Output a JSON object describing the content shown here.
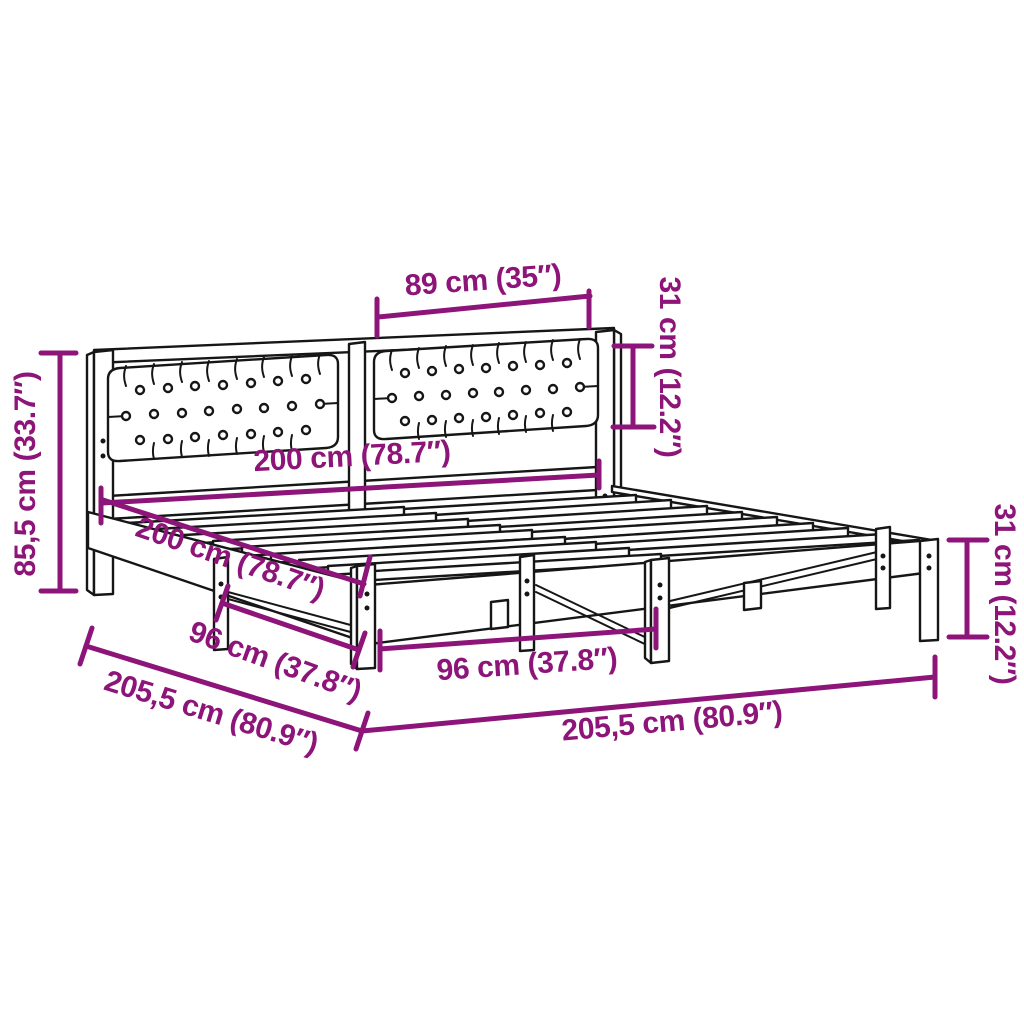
{
  "figure": {
    "type": "product dimension diagram",
    "subject": "bed frame with upholstered headboard (two tufted cushion panels, slatted base)",
    "accent_color": "#8d1478",
    "line_color": "#161616",
    "background_color": "#ffffff"
  },
  "dimensions": [
    {
      "id": "headboard-cushion-width",
      "label": "89 cm (35″)"
    },
    {
      "id": "headboard-cushion-height",
      "label": "31 cm (12.2″)"
    },
    {
      "id": "total-height",
      "label": "85,5 cm (33.7″)"
    },
    {
      "id": "bed-width-back",
      "label": "200 cm (78.7″)"
    },
    {
      "id": "bed-length-side",
      "label": "200 cm (78.7″)"
    },
    {
      "id": "support-span-left",
      "label": "96 cm (37.8″)"
    },
    {
      "id": "frame-length-left",
      "label": "205,5 cm (80.9″)"
    },
    {
      "id": "support-span-front",
      "label": "96 cm (37.8″)"
    },
    {
      "id": "frame-width-front",
      "label": "205,5 cm (80.9″)"
    },
    {
      "id": "base-height-right",
      "label": "31 cm (12.2″)"
    }
  ]
}
